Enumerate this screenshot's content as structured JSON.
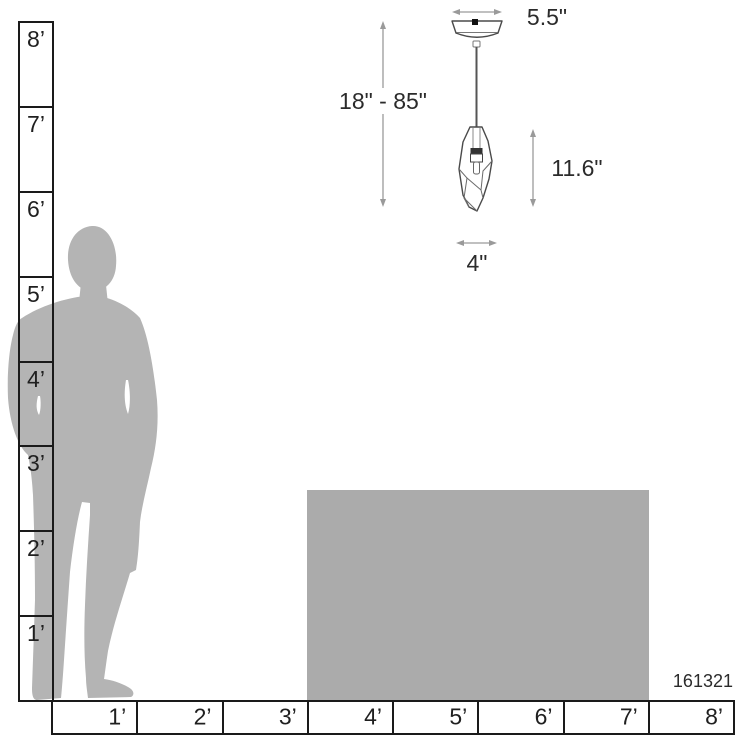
{
  "product_code": "161321",
  "dimensions": {
    "canopy_width": "5.5\"",
    "drop_range": "18\" - 85\"",
    "shade_height": "11.6\"",
    "shade_width": "4\""
  },
  "vertical_ruler": {
    "labels": [
      "8’",
      "7’",
      "6’",
      "5’",
      "4’",
      "3’",
      "2’",
      "1’"
    ]
  },
  "horizontal_ruler": {
    "labels": [
      "1’",
      "2’",
      "3’",
      "4’",
      "5’",
      "6’",
      "7’",
      "8’"
    ]
  },
  "colors": {
    "silhouette": "#b4b4b4",
    "table": "#ababab",
    "ruler-stroke": "#1a1a1a",
    "label-text": "#1f1f1f",
    "dim-line": "#9a9a9a",
    "dim-text": "#2b2b2b",
    "fixture-stroke": "#4a4a4a"
  }
}
